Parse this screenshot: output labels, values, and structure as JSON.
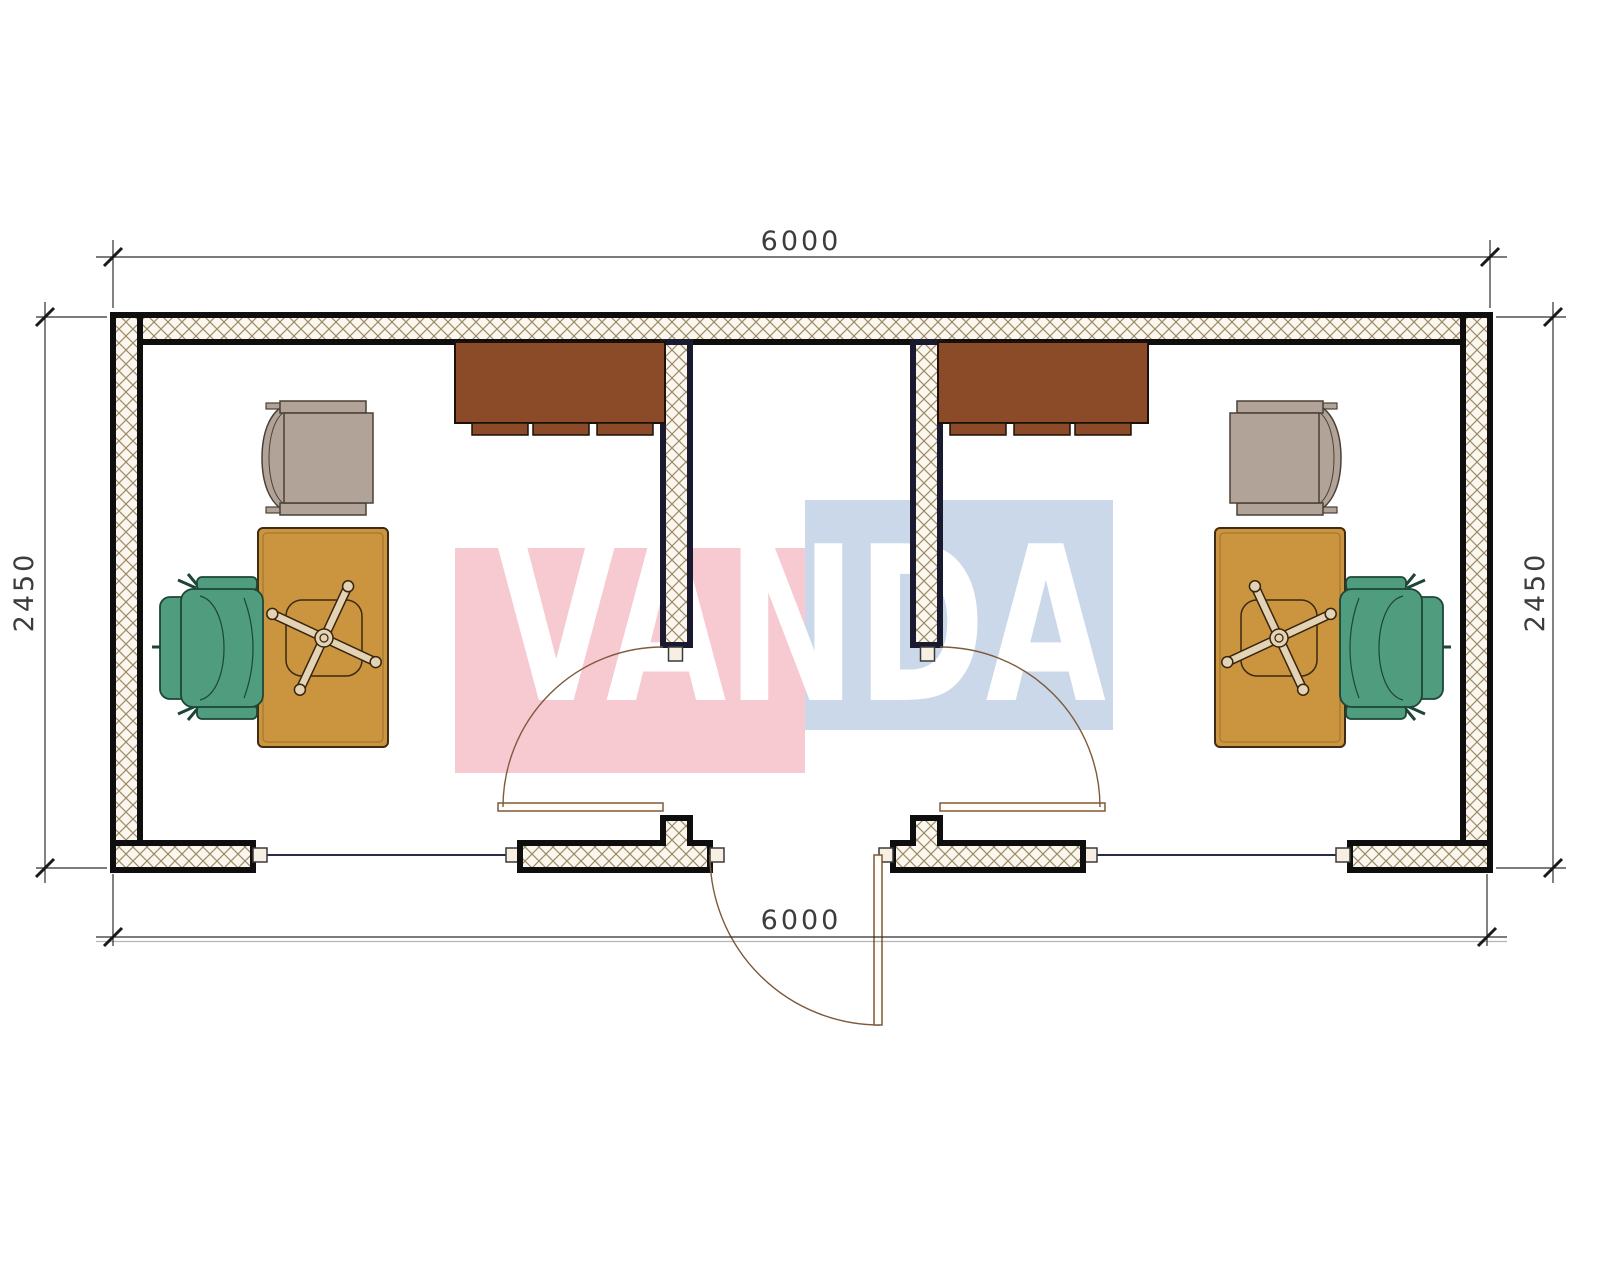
{
  "drawing": {
    "title": "Office container floor plan 6000 x 2450",
    "dimensions": {
      "top": "6000",
      "bottom": "6000",
      "left": "2450",
      "right": "2450"
    },
    "watermark": "VANDA",
    "elements": {
      "rooms": [
        "left-office",
        "entry-corridor",
        "right-office"
      ],
      "furniture": [
        "wardrobe-cabinet",
        "armchair",
        "desk",
        "office-chair"
      ],
      "openings": [
        "left-window",
        "right-window",
        "entry-door",
        "left-room-door",
        "right-room-door"
      ]
    },
    "colors": {
      "wall-fill": "#fbf7ee",
      "hatch-line": "#9b8a68",
      "outline": "#0e0e0e",
      "partition": "#191930",
      "desk": "#cb9540",
      "cabinet": "#8b4a28",
      "chair-green": "#4f9c7f",
      "chair-green-dark": "#1d4636",
      "armchair": "#b1a398",
      "armchair-dark": "#4a4036",
      "door": "#7d5a3a",
      "dim": "#2e2e2e",
      "wm-pink": "#f7c9d1",
      "wm-blue": "#cbd8ea",
      "wm-text": "#ffffff",
      "glass": "#2a2a4a"
    }
  }
}
